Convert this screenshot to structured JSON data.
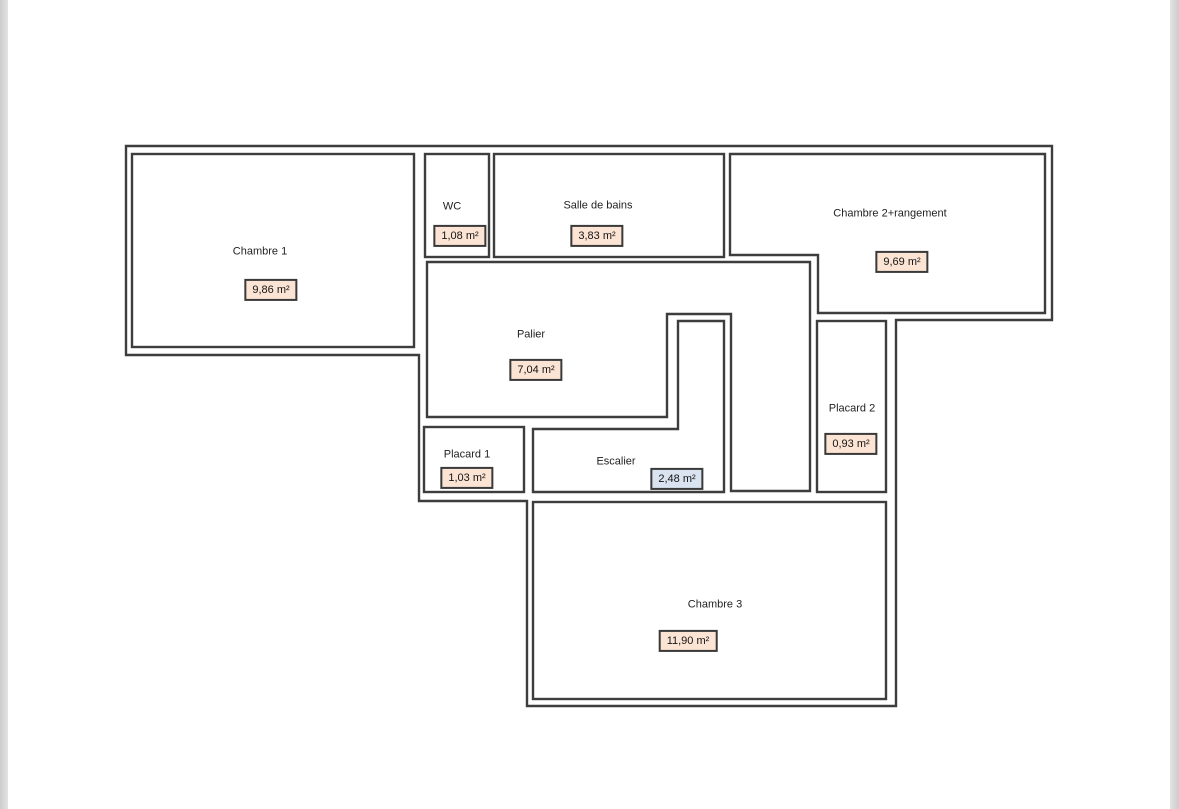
{
  "page": {
    "background_color": "#ffffff",
    "edge_strip_color": "#d9d9d9"
  },
  "plan": {
    "wall_color": "#3d3d3d",
    "room_fill_color": "#ffffff",
    "area_box_default_fill": "#fce4d4",
    "area_box_highlight_fill": "#dae4f0",
    "rooms": [
      {
        "id": "chambre-1",
        "label": "Chambre 1",
        "area": "9,86 m²",
        "box_fill": "#fce4d4"
      },
      {
        "id": "wc",
        "label": "WC",
        "area": "1,08 m²",
        "box_fill": "#fce4d4"
      },
      {
        "id": "salle-de-bains",
        "label": "Salle de bains",
        "area": "3,83 m²",
        "box_fill": "#fce4d4"
      },
      {
        "id": "chambre-2-rangement",
        "label": "Chambre 2+rangement",
        "area": "9,69 m²",
        "box_fill": "#fce4d4"
      },
      {
        "id": "palier",
        "label": "Palier",
        "area": "7,04 m²",
        "box_fill": "#fce4d4"
      },
      {
        "id": "placard-1",
        "label": "Placard 1",
        "area": "1,03 m²",
        "box_fill": "#fce4d4"
      },
      {
        "id": "escalier",
        "label": "Escalier",
        "area": "2,48 m²",
        "box_fill": "#dae4f0"
      },
      {
        "id": "placard-2",
        "label": "Placard 2",
        "area": "0,93 m²",
        "box_fill": "#fce4d4"
      },
      {
        "id": "chambre-3",
        "label": "Chambre 3",
        "area": "11,90 m²",
        "box_fill": "#fce4d4"
      }
    ]
  }
}
